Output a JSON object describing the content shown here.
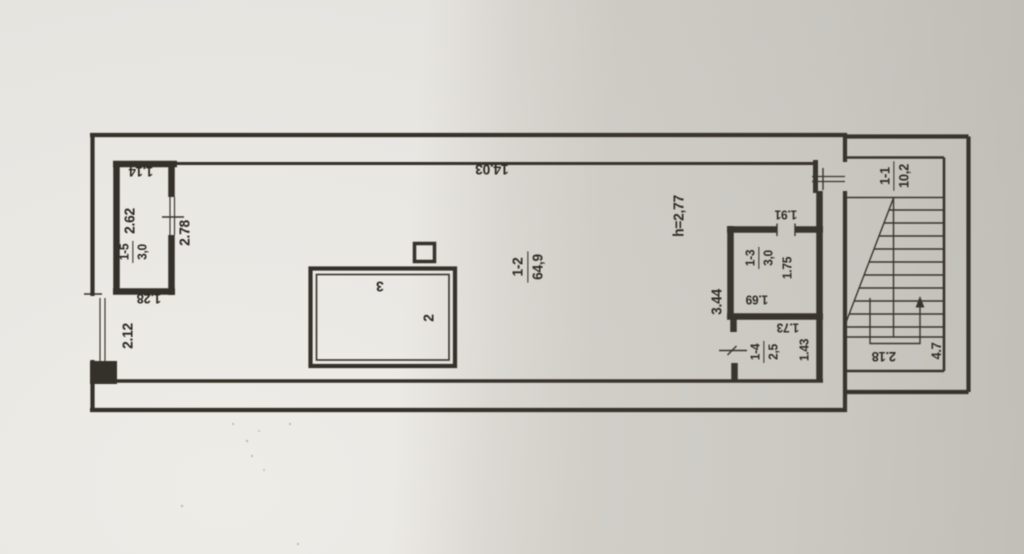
{
  "colors": {
    "paper": "#e9e7e2",
    "paper_shadow": "#cfccc6",
    "ink": "#34302a",
    "text_ink": "#2a2621"
  },
  "labels": {
    "dims": {
      "overall_length": "14.03",
      "ceiling_height": "h=2,77",
      "d1_14": "1.14",
      "d2_62": "2.62",
      "d2_78": "2.78",
      "d1_28": "1.28",
      "d2_12": "2.12",
      "d3_44": "3.44",
      "d1_91": "1.91",
      "d1_75": "1.75",
      "d1_69": "1.69",
      "d1_73": "1.73",
      "d1_43": "1.43",
      "d2_18": "2.18",
      "d4_7": "4.7"
    },
    "rooms": {
      "r11": {
        "number": "1-1",
        "area": "10,2"
      },
      "r12": {
        "number": "1-2",
        "area": "64,9"
      },
      "r13": {
        "number": "1-3",
        "area": "3,0"
      },
      "r14": {
        "number": "1-4",
        "area": "2,5"
      },
      "r15": {
        "number": "1-5",
        "area": "3,0"
      }
    },
    "items": {
      "item2": "2",
      "item3": "3"
    }
  }
}
